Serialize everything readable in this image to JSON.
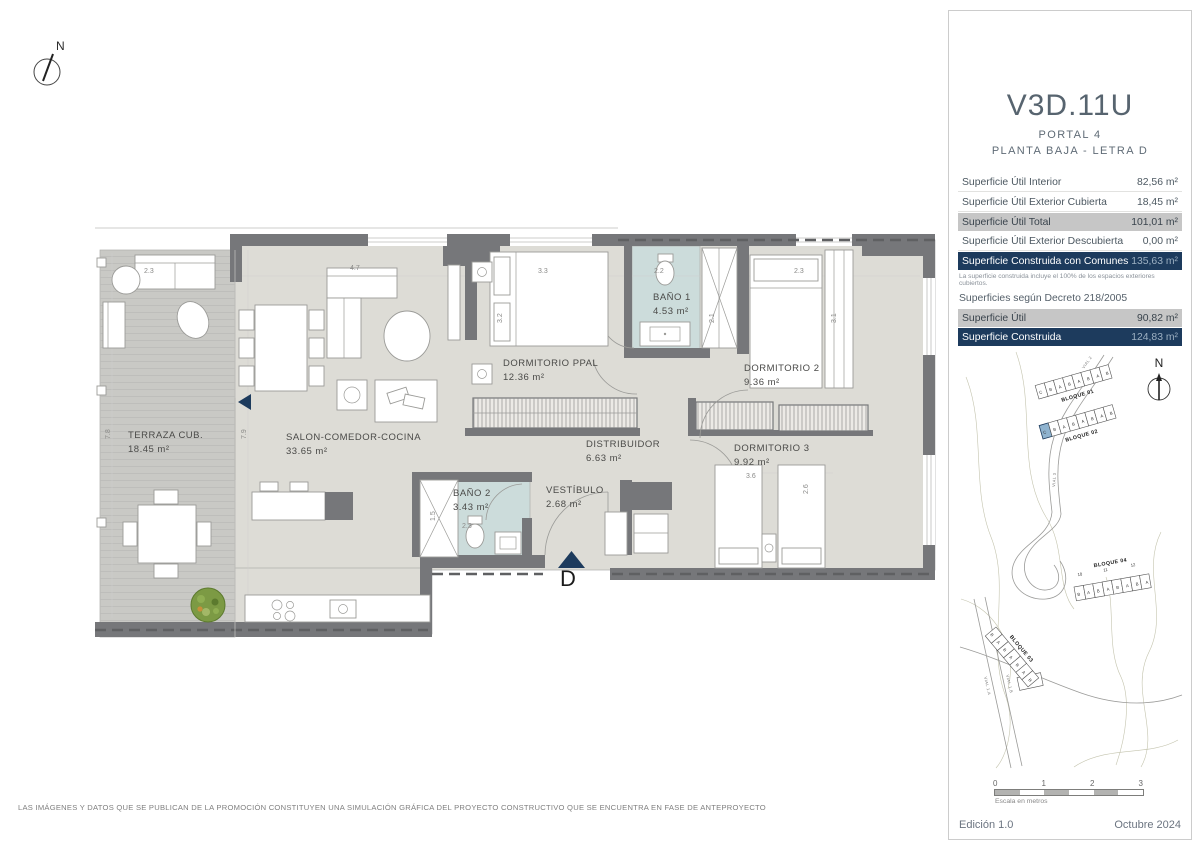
{
  "compass": {
    "label": "N"
  },
  "plan": {
    "rooms": [
      {
        "name": "TERRAZA CUB.",
        "area": "18.45 m²"
      },
      {
        "name": "SALON-COMEDOR-COCINA",
        "area": "33.65 m²"
      },
      {
        "name": "DORMITORIO PPAL",
        "area": "12.36 m²"
      },
      {
        "name": "BAÑO 1",
        "area": "4.53 m²"
      },
      {
        "name": "DORMITORIO 2",
        "area": "9.36 m²"
      },
      {
        "name": "DISTRIBUIDOR",
        "area": "6.63 m²"
      },
      {
        "name": "DORMITORIO 3",
        "area": "9.92 m²"
      },
      {
        "name": "BAÑO 2",
        "area": "3.43 m²"
      },
      {
        "name": "VESTÍBULO",
        "area": "2.68 m²"
      }
    ],
    "entrance_label": "D",
    "dims": [
      "2.3",
      "4.7",
      "3.3",
      "2.2",
      "2.3",
      "3.2",
      "2.1",
      "3.1",
      "7.8",
      "7.9",
      "3.6",
      "2.6",
      "1.5",
      "2.3"
    ]
  },
  "panel": {
    "title": "V3D.11U",
    "portal": "PORTAL 4",
    "floor": "PLANTA BAJA - LETRA D",
    "surface_rows": [
      {
        "label": "Superficie Útil Interior",
        "value": "82,56 m²"
      },
      {
        "label": "Superficie Útil Exterior Cubierta",
        "value": "18,45 m²"
      },
      {
        "label": "Superficie Útil Total",
        "value": "101,01 m²"
      },
      {
        "label": "Superficie Útil Exterior Descubierta",
        "value": "0,00 m²"
      },
      {
        "label": "Superficie Construida con Comunes",
        "value": "135,63 m²"
      }
    ],
    "note": "La superficie construida incluye el 100% de los espacios exteriores cubiertos.",
    "decree_heading": "Superficies según Decreto 218/2005",
    "decree_rows": [
      {
        "label": "Superficie Útil",
        "value": "90,82 m²"
      },
      {
        "label": "Superficie Construida",
        "value": "124,83 m²"
      }
    ],
    "siteplan": {
      "north_label": "N",
      "blocks": [
        {
          "label": "BLOQUE 01",
          "units": "C B A B A B A B"
        },
        {
          "label": "BLOQUE 02",
          "units": "C B A B A B A B"
        },
        {
          "label": "BLOQUE 03",
          "units": "B A B A B A B"
        },
        {
          "label": "BLOQUE 04",
          "units": "B A B A B A B A"
        }
      ],
      "block04_numbers": [
        "10",
        "11",
        "12"
      ],
      "roads": [
        "VIAL 2",
        "VIAL 3",
        "VIAL 1.A",
        "VIAL 1.B"
      ]
    },
    "scale": {
      "ticks": [
        "0",
        "1",
        "2",
        "3"
      ],
      "caption": "Escala en metros"
    },
    "edition": "Edición 1.0",
    "date": "Octubre 2024"
  },
  "footer_disclaimer": "LAS IMÁGENES Y DATOS QUE SE PUBLICAN DE LA PROMOCIÓN CONSTITUYEN UNA SIMULACIÓN GRÁFICA DEL PROYECTO CONSTRUCTIVO QUE SE ENCUENTRA EN FASE DE ANTEPROYECTO",
  "colors": {
    "navy": "#1d3b5d",
    "gray_row": "#c6c6c6",
    "bath": "#ccdcdb",
    "floor": "#dddcd6",
    "terrace": "#c9c9c5",
    "wall": "#76777a",
    "highlight_unit": "#8fb3cf"
  }
}
